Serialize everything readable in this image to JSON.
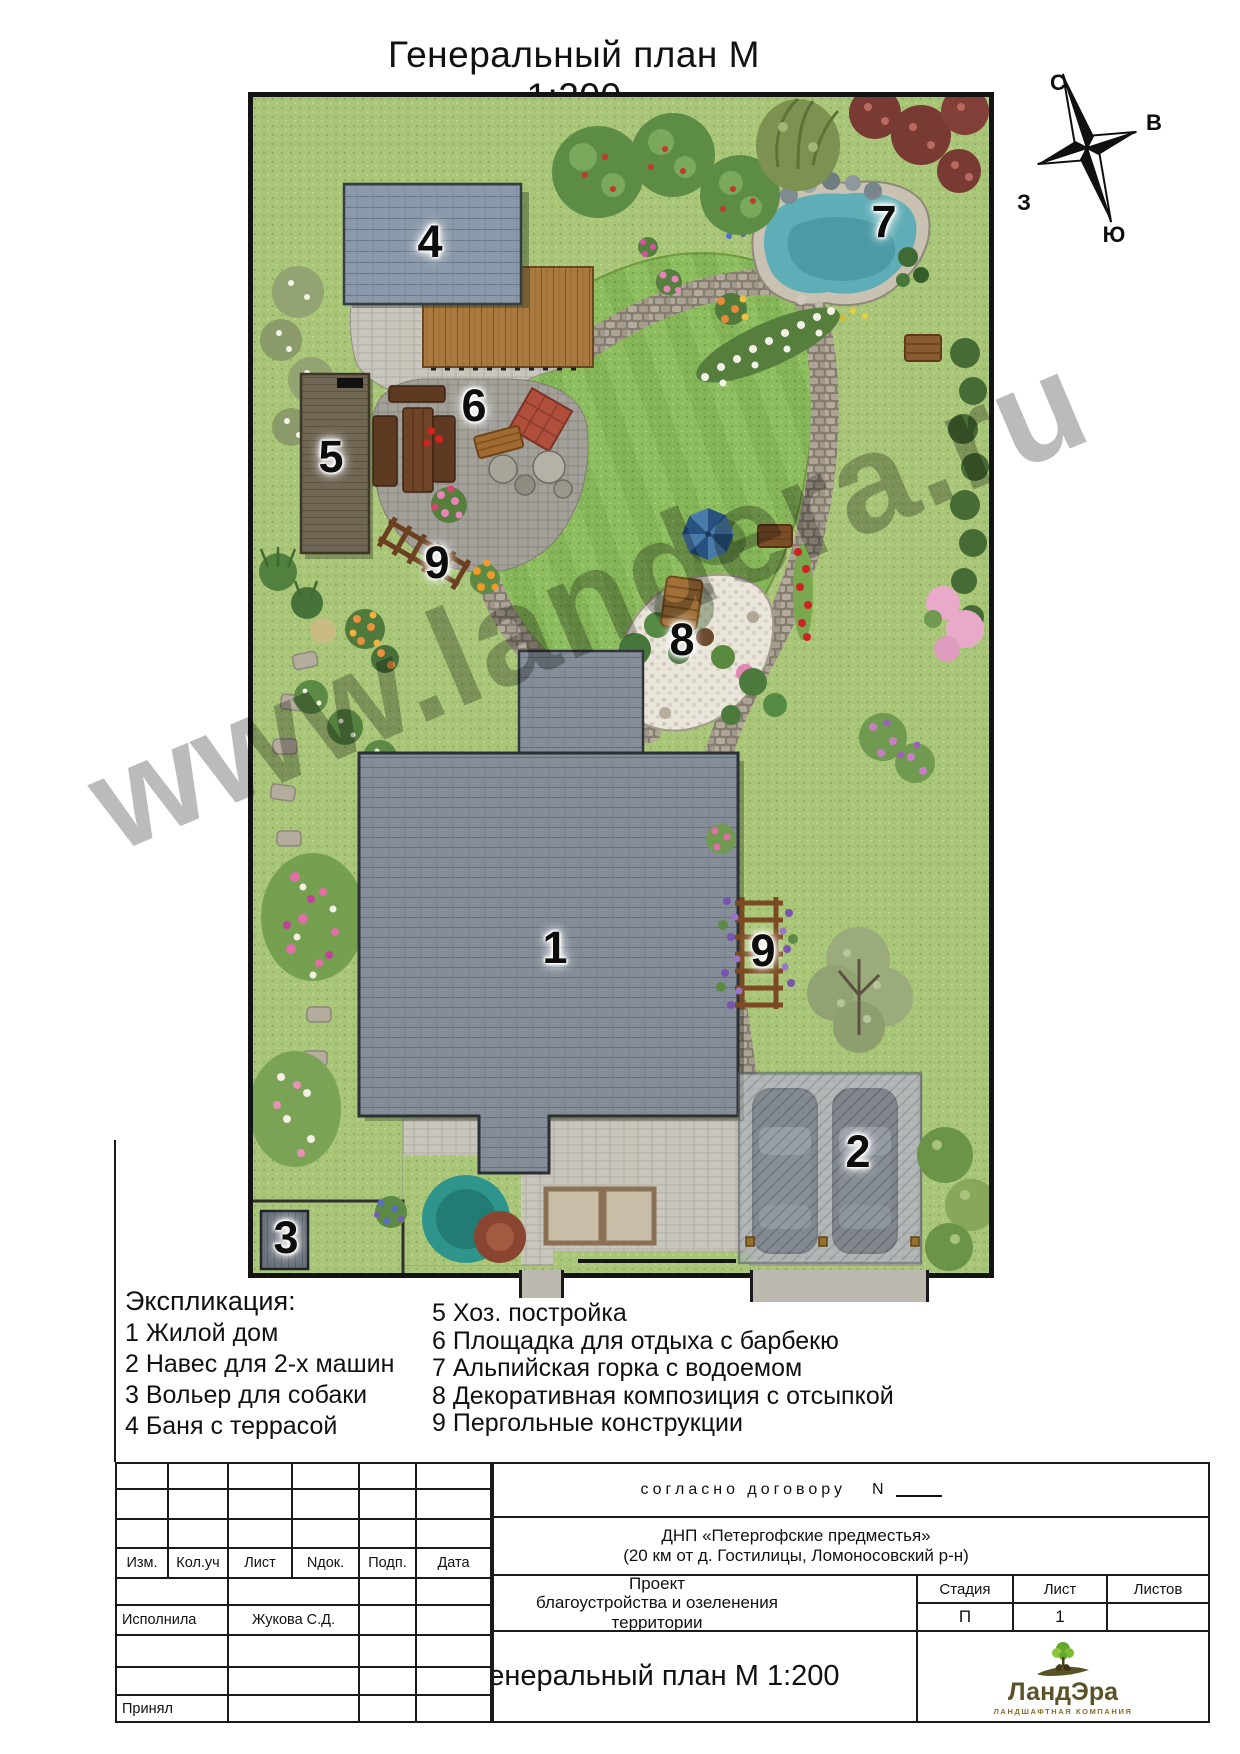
{
  "page": {
    "title": "Генеральный план  М 1:200"
  },
  "compass": {
    "north": "С",
    "east": "В",
    "west": "З",
    "south": "Ю"
  },
  "watermark": {
    "text": "www.landera.ru"
  },
  "plan": {
    "labels": {
      "house": "1",
      "carport": "2",
      "kennel": "3",
      "sauna": "4",
      "shed": "5",
      "bbq": "6",
      "rockery": "7",
      "decor": "8",
      "pergola_left": "9",
      "pergola_right": "9"
    }
  },
  "legend": {
    "heading": "Экспликация:",
    "col1": [
      "1 Жилой дом",
      "2 Навес для 2-х машин",
      "3 Вольер для собаки",
      "4 Баня с террасой"
    ],
    "col2": [
      "5 Хоз. постройка",
      "6 Площадка для отдыха с барбекю",
      "7 Альпийская горка с водоемом",
      "8 Декоративная композиция с отсыпкой",
      "9 Пергольные конструкции"
    ]
  },
  "titleblock": {
    "contract_label": "согласно договору",
    "contract_number_label": "N",
    "header_cols": [
      "Изм.",
      "Кол.уч",
      "Лист",
      "Nдок.",
      "Подп.",
      "Дата"
    ],
    "executor_label": "Исполнила",
    "executor_name": "Жукова С.Д.",
    "accepted_label": "Принял",
    "site_line1": "ДНП «Петергофские предместья»",
    "site_line2": "(20 км от д. Гостилицы, Ломоносовский р-н)",
    "project_line1": "Проект",
    "project_line2": "благоустройства и озеленения",
    "project_line3": "территории",
    "stage_label": "Стадия",
    "stage_value": "П",
    "sheet_label": "Лист",
    "sheet_value": "1",
    "sheets_label": "Листов",
    "sheets_value": "",
    "drawing_title": "Генеральный план М 1:200",
    "logo_name": "ЛандЭра",
    "logo_subtitle": "ЛАНДШАФТНАЯ КОМПАНИЯ"
  }
}
